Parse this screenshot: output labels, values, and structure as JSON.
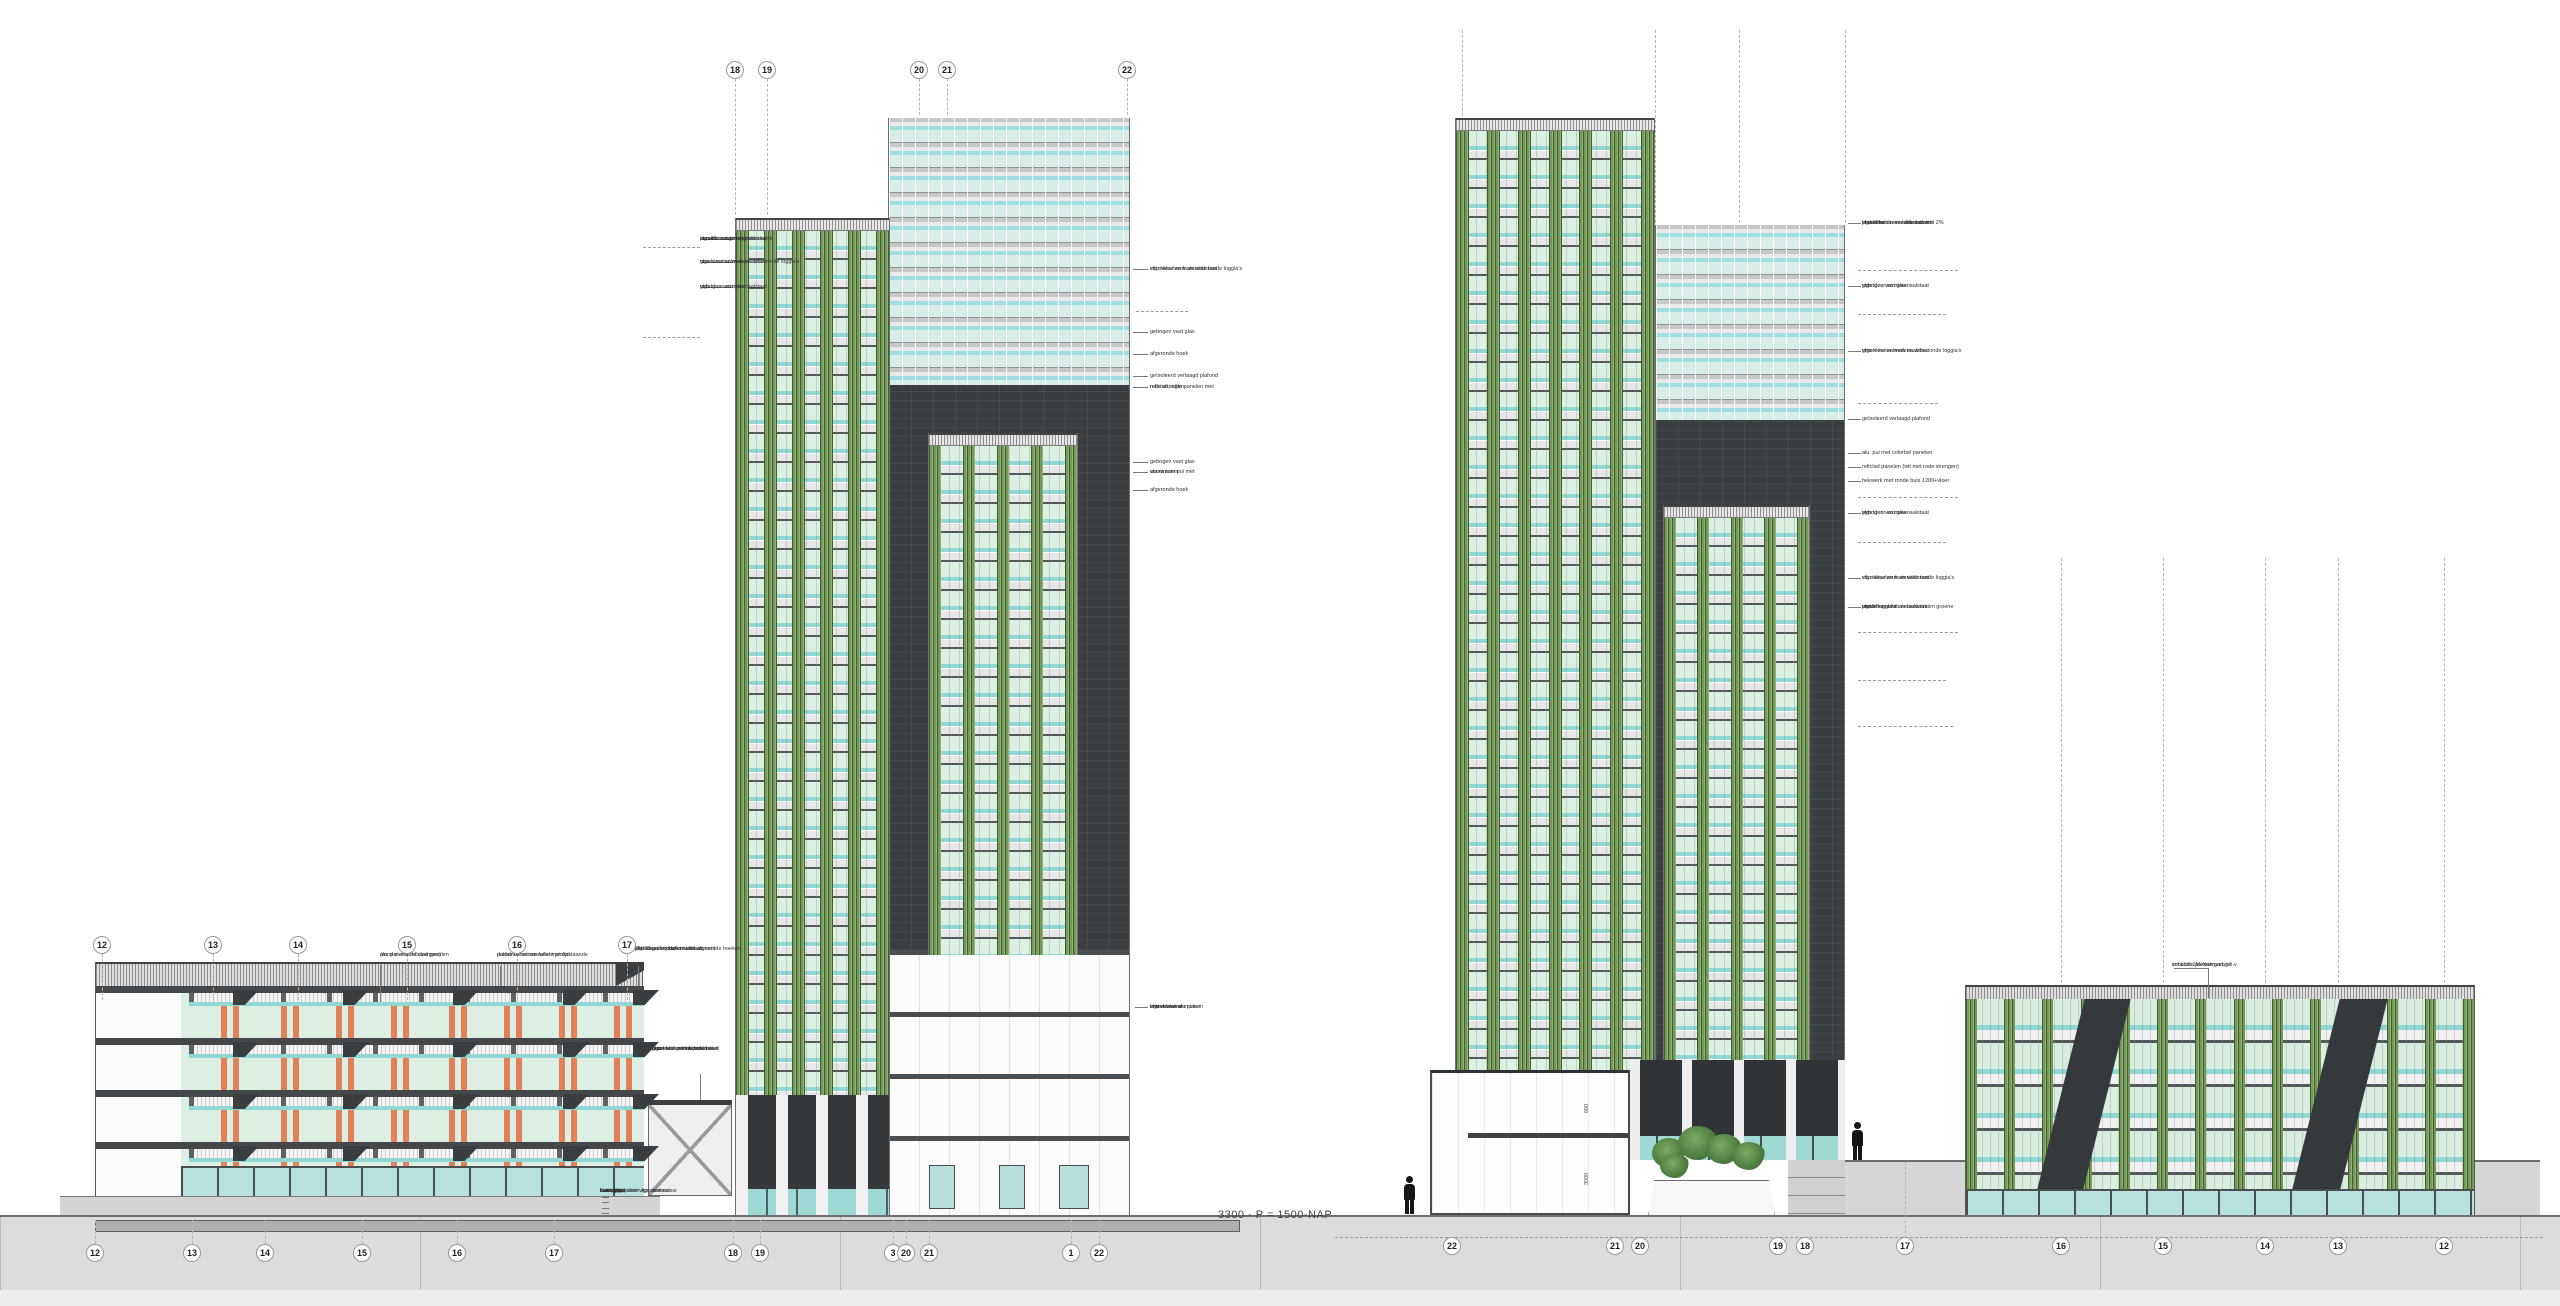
{
  "datum_label": "3300 - P = 1500-NAP",
  "dims": [
    "600",
    "3000"
  ],
  "colors": {
    "pier_green": "#74995a",
    "mint_glass": "#dcefe3",
    "aqua_glass": "#8fd8d4",
    "dark_facade": "#3a3e40",
    "orange_strand": "#e08157",
    "hatch_band": "#dedede",
    "ground": "#dcdcdc"
  },
  "grid": {
    "rows": [
      {
        "name": "top",
        "y": 70,
        "items": [
          {
            "t": "18",
            "x": 735,
            "d1": 79,
            "d2": 215
          },
          {
            "t": "19",
            "x": 767,
            "d1": 79,
            "d2": 215
          },
          {
            "t": "20",
            "x": 919,
            "d1": 79,
            "d2": 115
          },
          {
            "t": "21",
            "x": 947,
            "d1": 79,
            "d2": 115
          },
          {
            "t": "22",
            "x": 1127,
            "d1": 79,
            "d2": 115
          }
        ]
      },
      {
        "name": "mid-left",
        "y": 945,
        "drop": [
          954,
          1000
        ],
        "items": [
          {
            "t": "12",
            "x": 102
          },
          {
            "t": "13",
            "x": 213
          },
          {
            "t": "14",
            "x": 298
          },
          {
            "t": "15",
            "x": 407
          },
          {
            "t": "16",
            "x": 517
          },
          {
            "t": "17",
            "x": 627
          }
        ]
      },
      {
        "name": "bottom-left",
        "y": 1253,
        "up": 1220,
        "items": [
          {
            "t": "12",
            "x": 95
          },
          {
            "t": "13",
            "x": 192
          },
          {
            "t": "14",
            "x": 265
          },
          {
            "t": "15",
            "x": 362
          },
          {
            "t": "16",
            "x": 457
          },
          {
            "t": "17",
            "x": 554
          },
          {
            "t": "18",
            "x": 733
          },
          {
            "t": "19",
            "x": 760
          },
          {
            "t": "3",
            "x": 893
          },
          {
            "t": "20",
            "x": 906
          },
          {
            "t": "21",
            "x": 929
          },
          {
            "t": "1",
            "x": 1071
          },
          {
            "t": "22",
            "x": 1099
          }
        ]
      },
      {
        "name": "bottom-right",
        "y": 1246,
        "items": [
          {
            "t": "22",
            "x": 1452
          },
          {
            "t": "21",
            "x": 1615
          },
          {
            "t": "20",
            "x": 1640
          },
          {
            "t": "19",
            "x": 1778
          },
          {
            "t": "18",
            "x": 1805
          },
          {
            "t": "17",
            "x": 1905
          },
          {
            "t": "16",
            "x": 2061
          },
          {
            "t": "15",
            "x": 2163
          },
          {
            "t": "14",
            "x": 2265
          },
          {
            "t": "13",
            "x": 2338
          },
          {
            "t": "12",
            "x": 2444
          }
        ]
      }
    ]
  },
  "annotations": [
    {
      "x": 700,
      "y": 236,
      "align": "r",
      "lines": [
        "penant met groen metselwerk",
        "en witte ronde loggia's",
        "vlgs kleur en materiaalstaat"
      ]
    },
    {
      "x": 700,
      "y": 259,
      "align": "r",
      "lines": [
        "groen metselwerk en witte ronde loggia's",
        "vlgs kleur en materiaalstaat"
      ]
    },
    {
      "x": 700,
      "y": 284,
      "align": "r",
      "lines": [
        "gebogen vast glas",
        "vlgs kleur en materiaalstaat"
      ]
    },
    {
      "x": 1150,
      "y": 266,
      "align": "l",
      "lines": [
        "wit metselwerk en witte ronde loggia's",
        "vlgs kleur en materiaalstaat"
      ]
    },
    {
      "x": 1150,
      "y": 329,
      "align": "l",
      "lines": [
        "gebogen vast glas"
      ]
    },
    {
      "x": 1150,
      "y": 351,
      "align": "l",
      "lines": [
        "afgeronde hoek"
      ]
    },
    {
      "x": 1150,
      "y": 373,
      "align": "l",
      "lines": [
        "geïsoleerd verlaagd plafond"
      ]
    },
    {
      "x": 1150,
      "y": 384,
      "align": "l",
      "lines": [
        "reficlad, witte panelen met",
        "rode strengen"
      ]
    },
    {
      "x": 1150,
      "y": 459,
      "align": "l",
      "lines": [
        "gebogen vast glas"
      ]
    },
    {
      "x": 1150,
      "y": 469,
      "align": "l",
      "lines": [
        "aluminium pui met",
        "vouwramen"
      ]
    },
    {
      "x": 1150,
      "y": 487,
      "align": "l",
      "lines": [
        "afgeronde hoek"
      ]
    },
    {
      "x": 1150,
      "y": 1004,
      "align": "l",
      "lines": [
        "entree met aluminium",
        "brandwerende puien",
        "vlgs adviseur"
      ]
    },
    {
      "x": 380,
      "y": 952,
      "align": "r",
      "lines": [
        "alu. pui met reficlad panelen",
        "(rood met witte strengen)"
      ]
    },
    {
      "x": 497,
      "y": 952,
      "align": "r",
      "lines": [
        "prefab betonnen luifel met opstaande",
        "dakrand met cannelure profiel"
      ]
    },
    {
      "x": 635,
      "y": 946,
      "align": "r",
      "lines": [
        "prefab galerij balkon met afgeronde hoeken",
        "2% titaandioxide en witte cement",
        "vlgs kleur en materiaalstaat"
      ]
    },
    {
      "x": 652,
      "y": 1046,
      "align": "l",
      "lines": [
        "poort van prefab beton met",
        "groot stalen hekwerk met",
        "betontableau en positie",
        "vlgs kleur en materiaalstaat"
      ]
    },
    {
      "x": 600,
      "y": 1189,
      "align": "r",
      "size": "small",
      "lines": [
        "betontegels",
        "bestrating",
        "zandpakket",
        "drainage systeem vlgs adviseur",
        "kanaalplaat vloer vlgs constructeur"
      ]
    },
    {
      "x": 1862,
      "y": 220,
      "align": "l",
      "lines": [
        "prefab betonnen dakrand met 2%",
        "titaandioxide en witte cement",
        "vlgs kleur en materiaalstaat"
      ]
    },
    {
      "x": 1862,
      "y": 283,
      "align": "l",
      "lines": [
        "gebogen vast glas",
        "vlgs kleur en materiaalstaat"
      ]
    },
    {
      "x": 1862,
      "y": 348,
      "align": "l",
      "lines": [
        "groen metselwerk en witte ronde loggia's",
        "vlgs kleur en materiaalstaat"
      ]
    },
    {
      "x": 1862,
      "y": 416,
      "align": "l",
      "lines": [
        "geïsoleerd verlaagd plafond"
      ]
    },
    {
      "x": 1862,
      "y": 450,
      "align": "l",
      "lines": [
        "alu. pui met colorbel panelen"
      ]
    },
    {
      "x": 1862,
      "y": 464,
      "align": "l",
      "lines": [
        "reficlad panelen (wit met rode strengen)"
      ]
    },
    {
      "x": 1862,
      "y": 478,
      "align": "l",
      "lines": [
        "hekwerk met ronde buis 1200+vloer"
      ]
    },
    {
      "x": 1862,
      "y": 510,
      "align": "l",
      "lines": [
        "gebogen vast glas",
        "vlgs kleur en materiaalstaat"
      ]
    },
    {
      "x": 1862,
      "y": 575,
      "align": "l",
      "lines": [
        "wit metselwerk en witte ronde loggia's",
        "vlgs kleur en materiaalstaat"
      ]
    },
    {
      "x": 1862,
      "y": 604,
      "align": "l",
      "lines": [
        "penant met wit metselwerk en groene",
        "ronde loggia's",
        "vlgs kleur en materiaalstaat"
      ]
    },
    {
      "x": 2172,
      "y": 962,
      "align": "r",
      "lines": [
        "schacht 1M+dakrand, t.b.v.",
        "ventilatie parkeergarage"
      ]
    }
  ],
  "lines": {
    "segs": [
      {
        "x": 702,
        "y": 239,
        "w": 31
      },
      {
        "x": 702,
        "y": 262,
        "w": 31
      },
      {
        "x": 702,
        "y": 287,
        "w": 31
      },
      {
        "x": 1133,
        "y": 269,
        "w": 15
      },
      {
        "x": 1133,
        "y": 332,
        "w": 15
      },
      {
        "x": 1133,
        "y": 354,
        "w": 15
      },
      {
        "x": 1133,
        "y": 376,
        "w": 15
      },
      {
        "x": 1133,
        "y": 387,
        "w": 15
      },
      {
        "x": 1133,
        "y": 462,
        "w": 15
      },
      {
        "x": 1133,
        "y": 472,
        "w": 15
      },
      {
        "x": 1133,
        "y": 490,
        "w": 15
      },
      {
        "x": 1135,
        "y": 1007,
        "w": 13
      },
      {
        "x": 380,
        "y": 965,
        "h": 37
      },
      {
        "x": 500,
        "y": 966,
        "h": 20
      },
      {
        "x": 638,
        "y": 966,
        "h": 20
      },
      {
        "x": 700,
        "y": 1074,
        "h": 26
      },
      {
        "x": 602,
        "y": 1191,
        "w": 7
      },
      {
        "x": 602,
        "y": 1197,
        "w": 7
      },
      {
        "x": 602,
        "y": 1202,
        "w": 7
      },
      {
        "x": 602,
        "y": 1208,
        "w": 7
      },
      {
        "x": 602,
        "y": 1213,
        "w": 7
      },
      {
        "x": 1848,
        "y": 223,
        "w": 13
      },
      {
        "x": 1848,
        "y": 286,
        "w": 13
      },
      {
        "x": 1848,
        "y": 351,
        "w": 13
      },
      {
        "x": 1848,
        "y": 419,
        "w": 13
      },
      {
        "x": 1848,
        "y": 453,
        "w": 13
      },
      {
        "x": 1848,
        "y": 467,
        "w": 13
      },
      {
        "x": 1848,
        "y": 481,
        "w": 13
      },
      {
        "x": 1848,
        "y": 513,
        "w": 13
      },
      {
        "x": 1848,
        "y": 578,
        "w": 13
      },
      {
        "x": 1848,
        "y": 607,
        "w": 13
      },
      {
        "x": 2174,
        "y": 968,
        "w": 34
      },
      {
        "x": 2208,
        "y": 968,
        "h": 30
      }
    ],
    "ticks": [
      {
        "x": 643,
        "y": 247,
        "w": 57
      },
      {
        "x": 643,
        "y": 337,
        "w": 57
      },
      {
        "x": 1136,
        "y": 311,
        "w": 52
      },
      {
        "x": 1858,
        "y": 270,
        "w": 100
      },
      {
        "x": 1858,
        "y": 314,
        "w": 88
      },
      {
        "x": 1858,
        "y": 403,
        "w": 80
      },
      {
        "x": 1858,
        "y": 497,
        "w": 100
      },
      {
        "x": 1858,
        "y": 542,
        "w": 88
      },
      {
        "x": 1858,
        "y": 632,
        "w": 100
      },
      {
        "x": 1858,
        "y": 680,
        "w": 88
      },
      {
        "x": 1858,
        "y": 726,
        "w": 95
      }
    ],
    "vdash": [
      {
        "x": 1462,
        "y1": 30,
        "y2": 116
      },
      {
        "x": 1655,
        "y1": 30,
        "y2": 223
      },
      {
        "x": 1739,
        "y1": 30,
        "y2": 223
      },
      {
        "x": 1845,
        "y1": 30,
        "y2": 223
      },
      {
        "x": 2061,
        "y1": 558,
        "y2": 983
      },
      {
        "x": 2163,
        "y1": 558,
        "y2": 983
      },
      {
        "x": 2265,
        "y1": 558,
        "y2": 983
      },
      {
        "x": 2338,
        "y1": 558,
        "y2": 983
      },
      {
        "x": 2444,
        "y1": 558,
        "y2": 983
      },
      {
        "x": 1905,
        "y1": 1162,
        "y2": 1238
      }
    ],
    "hdatum": {
      "x": 1335,
      "y": 1237,
      "w": 1208
    }
  },
  "figures": [
    {
      "x": 1404,
      "y": 1176
    },
    {
      "x": 1852,
      "y": 1122
    }
  ]
}
